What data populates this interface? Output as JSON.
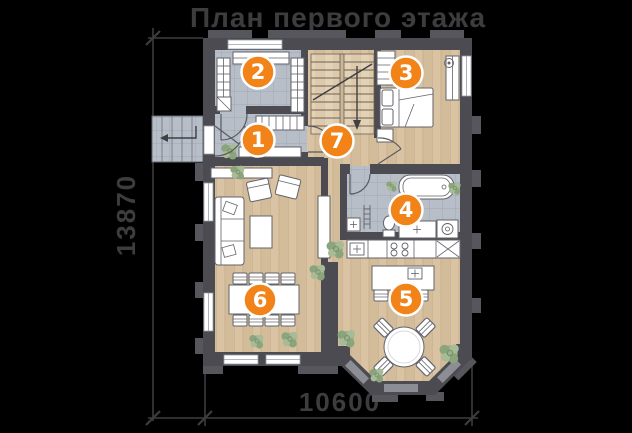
{
  "title": "План первого этажа",
  "dimensions": {
    "height_label": "13870",
    "width_label": "10600"
  },
  "rooms": [
    {
      "number": "1"
    },
    {
      "number": "2"
    },
    {
      "number": "3"
    },
    {
      "number": "4"
    },
    {
      "number": "5"
    },
    {
      "number": "6"
    },
    {
      "number": "7"
    }
  ],
  "colors": {
    "background": "#000000",
    "wall": "#4b4b51",
    "wall_pilaster": "#56565c",
    "wood_floor": "#d8c2a1",
    "tile_floor": "#b7bec8",
    "marker_orange": "#f28318",
    "marker_text": "#ffffff",
    "annotation_text": "#3d3d3d",
    "plant_green": "#9cb08e",
    "furniture_white": "#ffffff"
  }
}
